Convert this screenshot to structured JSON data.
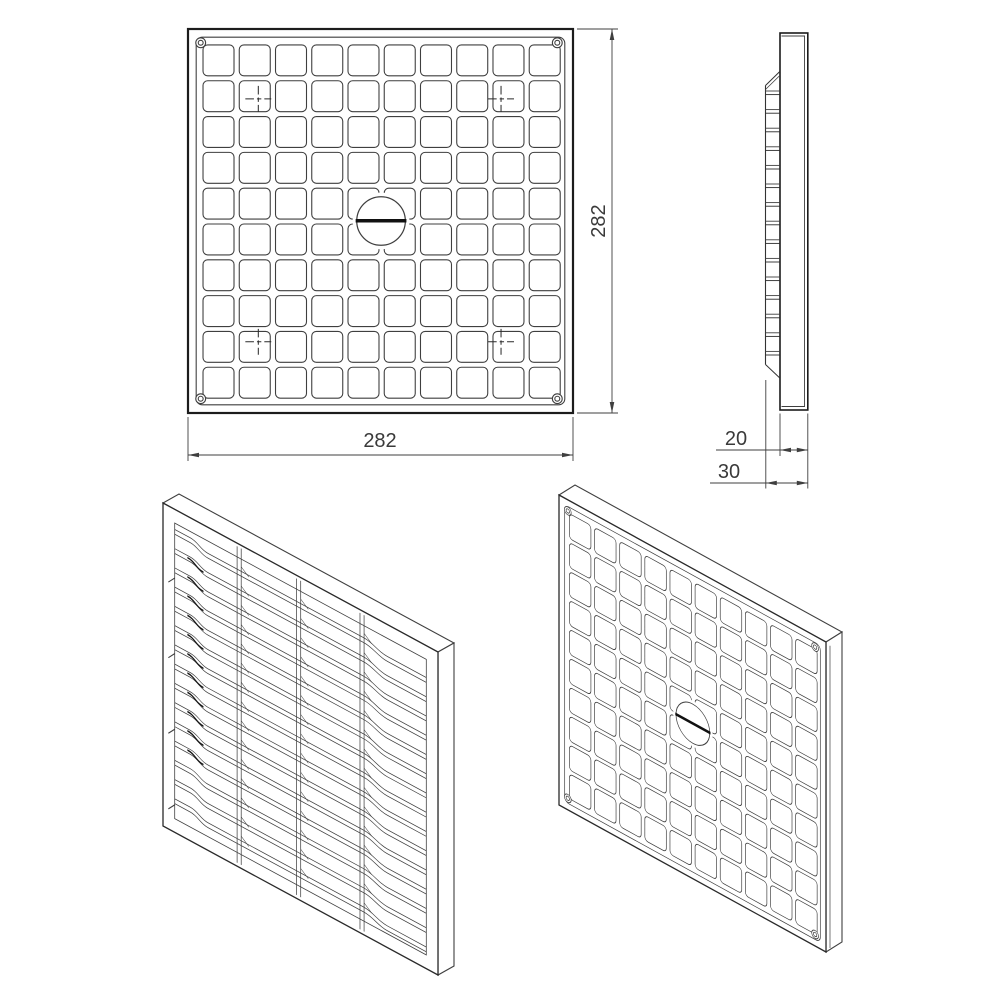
{
  "drawing": {
    "kind": "technical-drawing",
    "object": "square louvered vent grille cover"
  },
  "dimension_labels": {
    "front_width": "282",
    "front_height": "282",
    "cover_thickness": "20",
    "overall_depth": "30"
  },
  "views": {
    "front": {
      "grid_cols": 10,
      "grid_rows": 10,
      "corner_rivets": 4,
      "fixing_hole_marks": 4,
      "center_screw_slot": true
    },
    "side": {
      "louver_slats": 15
    },
    "iso_back": {
      "louver_slats": 15,
      "vertical_ribs": 3
    },
    "iso_front": {
      "grid_cols": 10,
      "grid_rows": 10
    }
  },
  "colors": {
    "background": "#ffffff",
    "line": "#3f3f3f",
    "line_dark": "#1c1c1c",
    "slot": "#111111",
    "text": "#3a3a3a"
  }
}
